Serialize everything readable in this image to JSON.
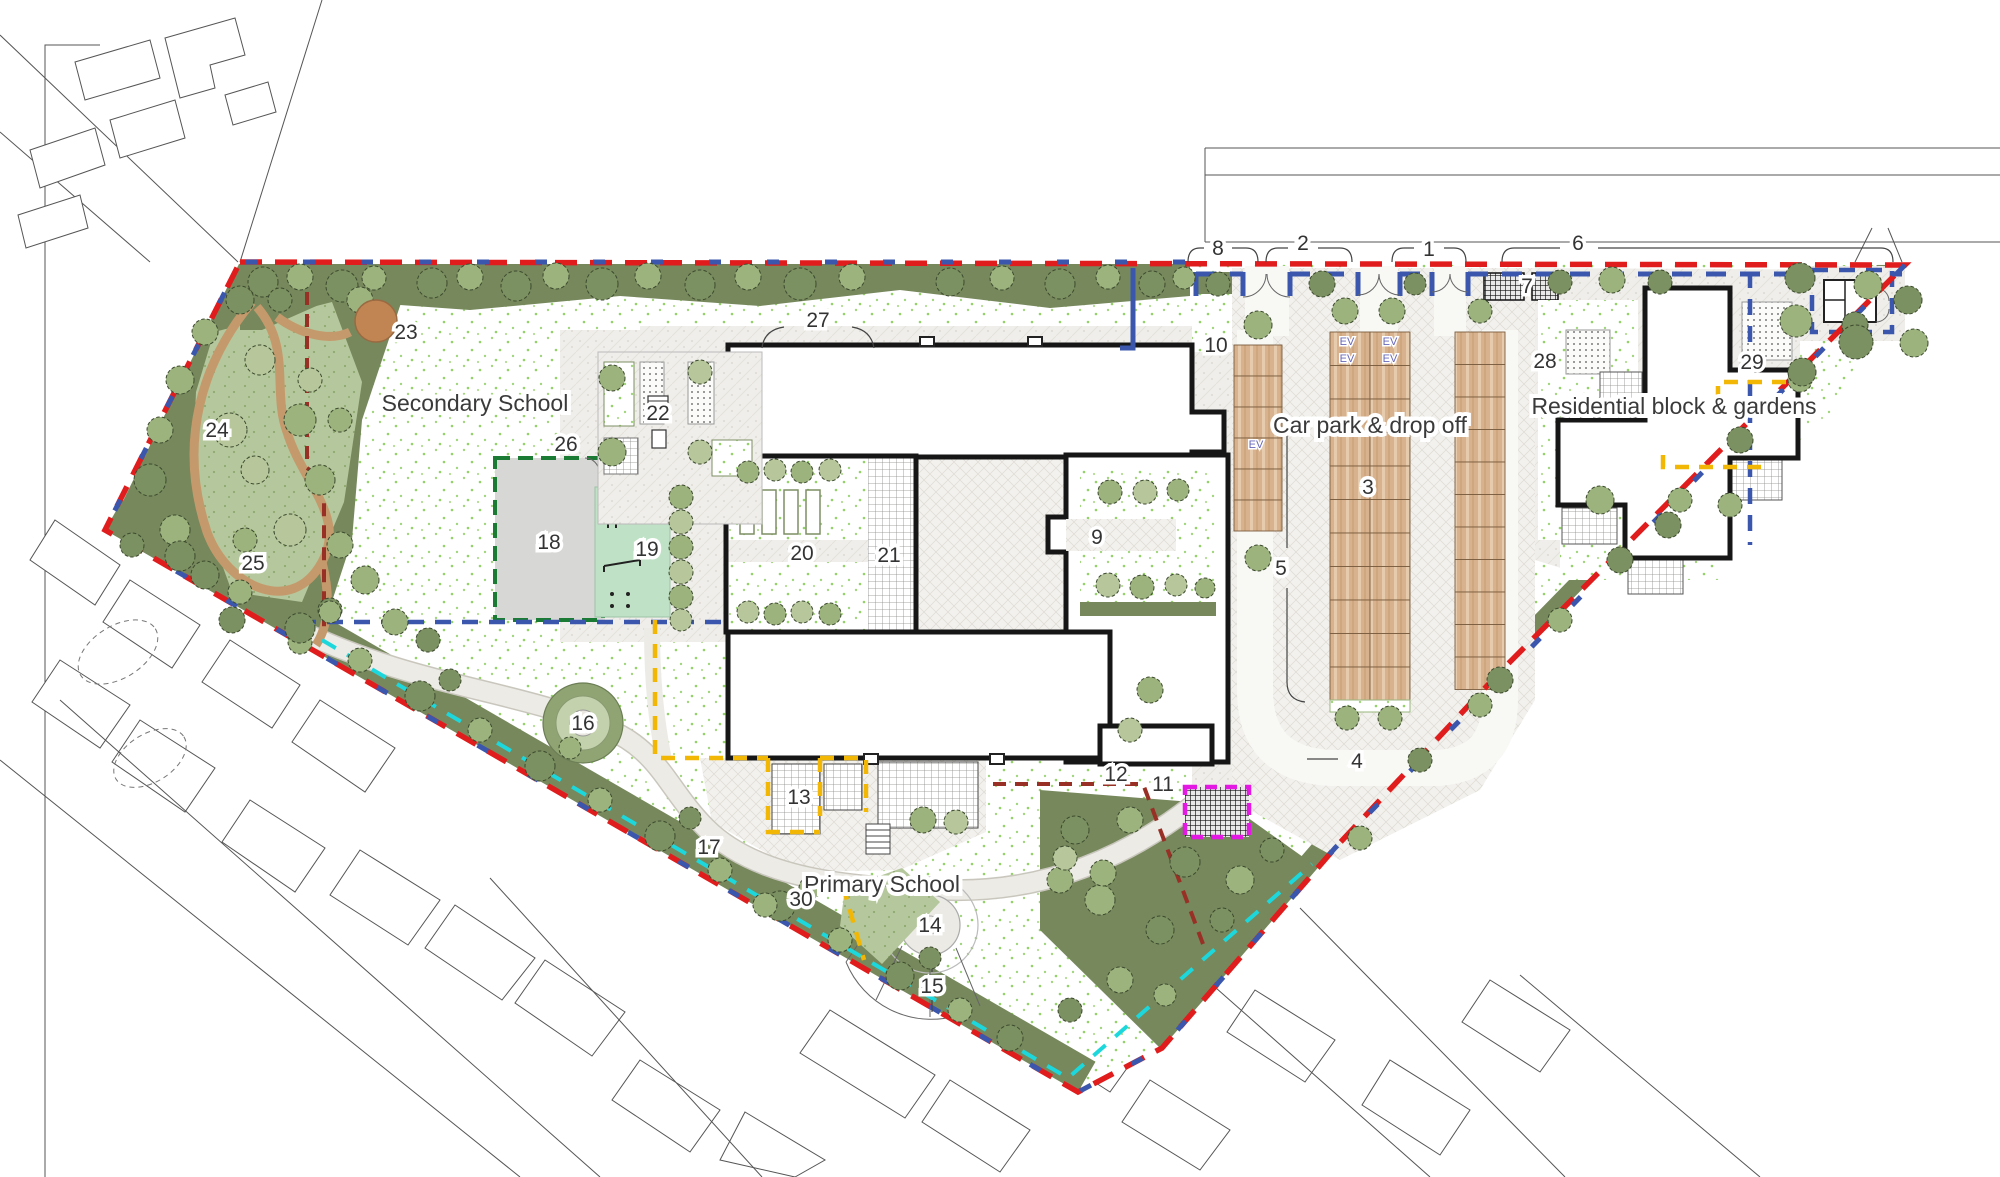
{
  "plan": {
    "areas": {
      "secondary_school": "Secondary School",
      "primary_school": "Primary School",
      "car_park": "Car park & drop off",
      "residential": "Residential block & gardens"
    },
    "ev_label": "EV",
    "annotations": [
      {
        "n": "1",
        "x": 1429,
        "y": 249
      },
      {
        "n": "2",
        "x": 1303,
        "y": 243
      },
      {
        "n": "3",
        "x": 1368,
        "y": 487
      },
      {
        "n": "4",
        "x": 1357,
        "y": 761
      },
      {
        "n": "5",
        "x": 1281,
        "y": 568
      },
      {
        "n": "6",
        "x": 1578,
        "y": 243
      },
      {
        "n": "7",
        "x": 1527,
        "y": 286
      },
      {
        "n": "8",
        "x": 1218,
        "y": 248
      },
      {
        "n": "9",
        "x": 1097,
        "y": 537
      },
      {
        "n": "10",
        "x": 1216,
        "y": 345
      },
      {
        "n": "11",
        "x": 1163,
        "y": 784
      },
      {
        "n": "12",
        "x": 1116,
        "y": 774
      },
      {
        "n": "13",
        "x": 799,
        "y": 797
      },
      {
        "n": "14",
        "x": 930,
        "y": 925
      },
      {
        "n": "15",
        "x": 932,
        "y": 986
      },
      {
        "n": "16",
        "x": 583,
        "y": 723
      },
      {
        "n": "17",
        "x": 709,
        "y": 847
      },
      {
        "n": "18",
        "x": 549,
        "y": 542
      },
      {
        "n": "19",
        "x": 647,
        "y": 549
      },
      {
        "n": "20",
        "x": 802,
        "y": 553
      },
      {
        "n": "21",
        "x": 889,
        "y": 555
      },
      {
        "n": "22",
        "x": 658,
        "y": 413
      },
      {
        "n": "23",
        "x": 406,
        "y": 332
      },
      {
        "n": "24",
        "x": 217,
        "y": 430
      },
      {
        "n": "25",
        "x": 253,
        "y": 563
      },
      {
        "n": "26",
        "x": 566,
        "y": 444
      },
      {
        "n": "27",
        "x": 818,
        "y": 320
      },
      {
        "n": "28",
        "x": 1545,
        "y": 361
      },
      {
        "n": "29",
        "x": 1752,
        "y": 362
      },
      {
        "n": "30",
        "x": 801,
        "y": 899
      }
    ],
    "ev_bays": [
      {
        "x": 1347,
        "y": 341
      },
      {
        "x": 1390,
        "y": 341
      },
      {
        "x": 1347,
        "y": 358
      },
      {
        "x": 1390,
        "y": 358
      },
      {
        "x": 1256,
        "y": 444
      }
    ],
    "colors": {
      "site_boundary_red": "#e01c1c",
      "secure_line_blue": "#3a57ad",
      "woodland_line_maroon": "#993026",
      "muga_line_green": "#1b7a33",
      "play_line_yellow": "#f2b705",
      "path_line_cyan": "#1cd8dd",
      "store_line_magenta": "#e318e3",
      "buffer_planting_olive": "#76885c",
      "parking_bay_tan": "#d8b28e",
      "play_area_mint": "#bfe2c6",
      "muga_grey": "#d7d7d5",
      "woodland_path_brown": "#c49a6c",
      "lawn_speckle_green": "#79c544"
    }
  }
}
